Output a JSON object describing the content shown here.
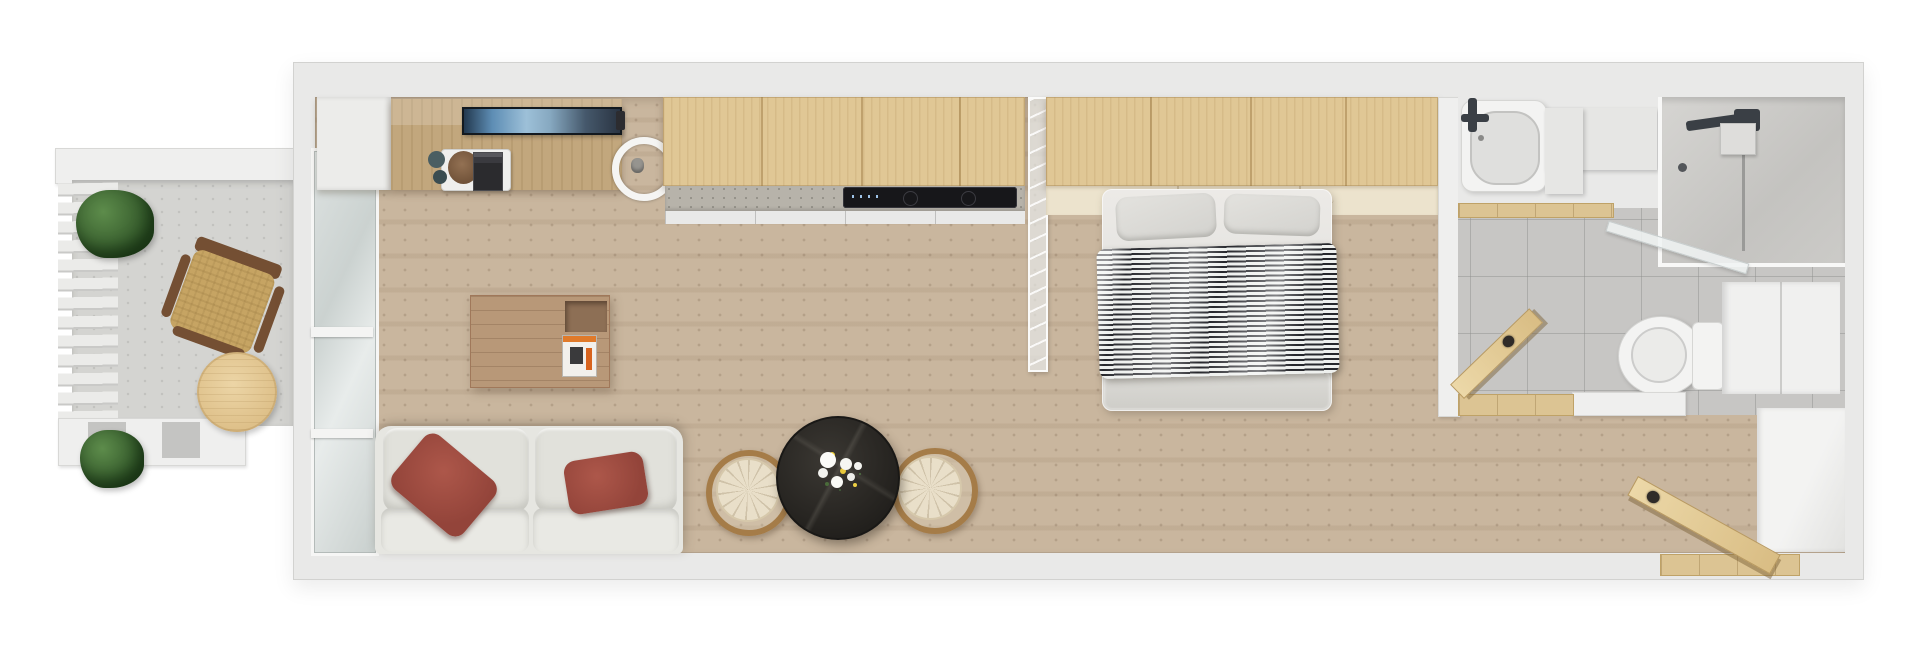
{
  "meta": {
    "type": "3d-floor-plan-top-down-render",
    "description": "Top-down 3D render of a long narrow studio apartment: left balcony with pergola louvers, living room with kitchenette, bedroom behind a glass partition, bathroom and entry corridor on the right. No text is rendered in the image."
  },
  "rooms": {
    "balcony": "Balcony",
    "living": "Living room with kitchenette",
    "bedroom": "Bedroom",
    "bathroom": "Bathroom",
    "entry": "Entry corridor"
  },
  "labels": {
    "louvers": "Pergola louver slats",
    "balcony_plant_top": "Potted green plant",
    "balcony_plant_bottom": "Potted green plant",
    "balcony_chair": "Wood-frame armchair with tan cushion",
    "balcony_table": "Round light-wood side table",
    "glass_wall": "Glazed balcony door wall",
    "entry_cabinet": "White storage cabinet",
    "console": "Wooden sideboard with decor tray",
    "tv": "Wall-mounted TV",
    "ring_lamp": "Round wall lamp",
    "kitchen_cabinets": "Light-wood kitchen cabinets",
    "counter": "Speckled worktop",
    "cooktop": "Black cooktop",
    "coffee_table": "Square wooden coffee table with magazine",
    "sofa": "Light grey sofa",
    "red_pillows": "Terracotta red cushions",
    "dining_table": "Round black marble table with white flowers",
    "dining_chair_left": "Rattan-back dining chair",
    "dining_chair_right": "Rattan-back dining chair",
    "partition": "Glass partition",
    "wardrobe": "Light-wood wardrobe with open shelf",
    "bed": "Double bed with black-and-white striped duvet",
    "pillows": "Bed pillows",
    "bathtub": "Bathtub with dark faucet",
    "bath_bench": "Wooden bench strip",
    "shower": "Walk-in shower with glass screen",
    "toilet": "Toilet",
    "bath_cabinet": "White bathroom cabinet",
    "bath_door": "Open wooden bathroom door",
    "entry_door": "Open wooden entrance door",
    "entry_closet": "White entry closet",
    "threshold": "Wooden threshold"
  },
  "palette": {
    "page_bg": "#ffffff",
    "wall": "#e9e9e8",
    "floor_travertine": "#c9b69e",
    "balcony_concrete": "#d4d4d1",
    "bath_tile": "#c7c6c4",
    "wood_maple": "#e0c795",
    "wood_mid": "#b89878",
    "wood_door": "#e0c68f",
    "sofa_grey": "#e6e6e1",
    "pillow_red": "#9c4a40",
    "duvet_stripe_dark": "#26272c",
    "duvet_stripe_light": "#eef0ee",
    "table_black": "#23211e",
    "plant_green": "#3f6f34",
    "tv_sky": "#9dc0d8",
    "chair_tan": "#c6a463"
  }
}
